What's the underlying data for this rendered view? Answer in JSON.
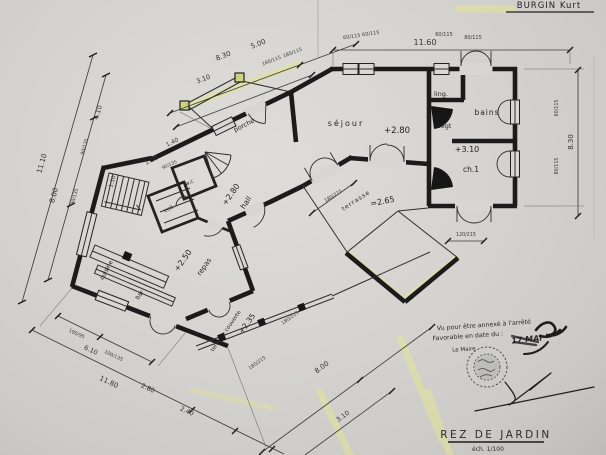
{
  "colors": {
    "paper": "#d5d4d0",
    "ink": "#1b1b1b",
    "highlighter": "#e4e496",
    "stamp_ink": "#4d4d4d"
  },
  "header": {
    "client_name": "BURGIN Kurt"
  },
  "title_block": {
    "title": "REZ DE JARDIN",
    "scale_label": "éch. 1/100"
  },
  "approval_stamp": {
    "line1": "Vu pour être annexé à l'arrêté",
    "line2": "Favorable en date du :",
    "handwritten_date": "17 MAI",
    "signataire": "Le Maire"
  },
  "rooms": {
    "porche": {
      "label": "porche"
    },
    "sejour": {
      "label": "séjour",
      "level": "+2.80"
    },
    "ling": {
      "label": "ling."
    },
    "bains": {
      "label": "bains"
    },
    "degt": {
      "label": "dégt",
      "level": "+3.10"
    },
    "ch1": {
      "label": "ch.1"
    },
    "hall": {
      "label": "hall",
      "level": "+2.80"
    },
    "wc": {
      "label": "w.c"
    },
    "cell": {
      "label": "cell."
    },
    "repas": {
      "label": "repas",
      "level": "+2.50"
    },
    "cuisine": {
      "label": "cuisine"
    },
    "bar": {
      "label": "bar"
    },
    "terrasse_couverte": {
      "label": "terrasse couverte",
      "level": "+2.35"
    },
    "terrasse": {
      "label": "terrasse",
      "level": "≈2.65"
    }
  },
  "dimensions": {
    "top_total": "11.60",
    "right_total": "8.30",
    "upper_left_a": "8.30",
    "upper_left_b": "5.00",
    "porch_width": "3.10",
    "left_total": "11.10",
    "left_inner": "8.00",
    "left_a": "4.10",
    "left_b": "1.10",
    "stair_a": "1.40",
    "stair_b": "1.10",
    "bottom_left_total": "11.80",
    "bottom_left_a": "6.10",
    "bottom_left_b": "2.80",
    "bottom_left_c": "2.40",
    "bottom_mid_total": "8.00",
    "bottom_mid_a": "3.10"
  },
  "openings": {
    "top_1": "60/115",
    "top_2": "60/115",
    "top_3": "60/115",
    "top_4": "80/115",
    "porch_1": "160/115",
    "porch_2": "180/115",
    "right_1": "60/115",
    "right_2": "80/115",
    "west_1": "90/135",
    "west_2": "90/135",
    "stair": "90/135",
    "bottom_left_1": "100/95",
    "bottom_left_2": "100/135",
    "terrace_1": "180/215",
    "terrace_2": "180/215",
    "terrace_3": "180/215",
    "terrace_4": "120/215"
  }
}
